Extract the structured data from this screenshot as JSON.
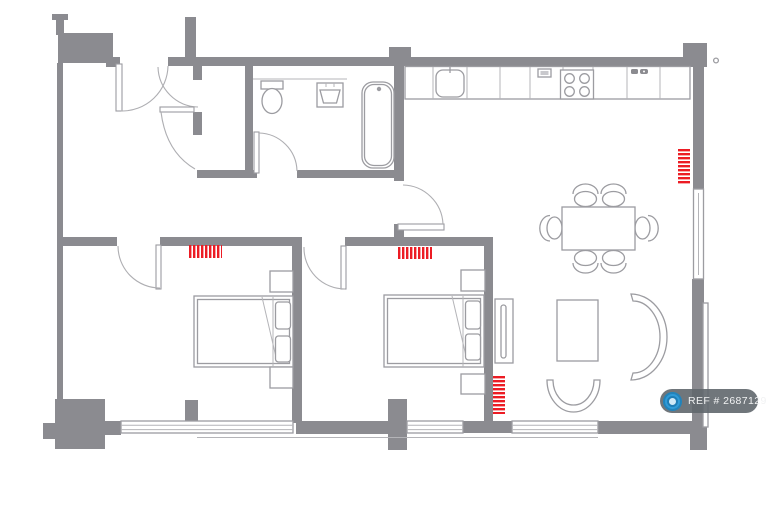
{
  "watermark": {
    "text": "REF # 2687129",
    "icon": "camera-icon"
  },
  "colors": {
    "wall": "#8b8b90",
    "outline": "#9c9ca1",
    "radiator": "#ec1c24",
    "watermark_bg": "rgba(96,103,109,0.9)",
    "watermark_icon_blue": "#2f9bd8"
  },
  "floorplan": {
    "radiator_count": 4,
    "symbols": [
      "entry-door",
      "vestibule-doors",
      "toilet",
      "washbasin",
      "bathtub",
      "kitchen-counter",
      "kitchen-sink",
      "hob-4-burner",
      "kitchen-switches",
      "double-bed",
      "double-bed",
      "bedside-tables",
      "dining-table-6-chairs",
      "coffee-table",
      "curved-armchair",
      "curved-chair",
      "tv-sideboard",
      "windows",
      "radiators"
    ]
  }
}
